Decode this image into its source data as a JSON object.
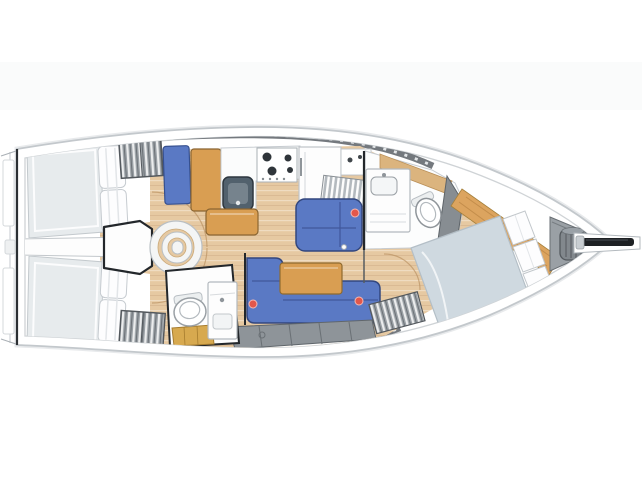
{
  "image": {
    "width": 642,
    "height": 481,
    "kind": "sailboat-interior-layout-plan",
    "orientation": "bow-right",
    "background": "#ffffff"
  },
  "palette": {
    "background": "#ffffff",
    "page_band": "#fafbfb",
    "hull_fill": "#ffffff",
    "hull_outline": "#c3c8cc",
    "hull_shadow": "#e8eaec",
    "gunwale": "#cfd3d6",
    "coachroof_band": "#74797e",
    "band_dash": "#e3e6e8",
    "floor_wood": "#e6c9a2",
    "floor_seam": "#c9a878",
    "furniture_wood": "#d99e52",
    "furniture_wood_edge": "#8a6532",
    "upholstery_blue": "#5a79c4",
    "upholstery_edge": "#33477e",
    "mattress_gray": "#e7ebed",
    "bed_duvet": "#cfd9e0",
    "pillow_white": "#fdfdfe",
    "locker_gray": "#9aa0a5",
    "locker_edge": "#53585d",
    "fixture_white": "#fdfdfd",
    "fixture_edge": "#b3b9be",
    "sink_slate": "#52616d",
    "accent_red": "#e2574b",
    "outline_dark": "#23272b",
    "windlass_gray": "#82888d",
    "bowsprit_black": "#1e2124",
    "gold_floor": "#d7a94f"
  },
  "regions": [
    {
      "id": "hull",
      "label": "hull outline"
    },
    {
      "id": "transom",
      "label": "stern transom with swim platform"
    },
    {
      "id": "aft-cabin-starboard",
      "label": "aft double cabin (top)"
    },
    {
      "id": "aft-cabin-port",
      "label": "aft double cabin (bottom)"
    },
    {
      "id": "companionway-steps",
      "label": "companionway steps"
    },
    {
      "id": "galley",
      "label": "galley with stove, sink, fridge"
    },
    {
      "id": "nav-seat",
      "label": "blue seat / chart area"
    },
    {
      "id": "saloon-settee-starboard",
      "label": "starboard settee"
    },
    {
      "id": "saloon-sofa-port",
      "label": "L-shaped port sofa"
    },
    {
      "id": "saloon-table",
      "label": "saloon table"
    },
    {
      "id": "aft-head",
      "label": "aft bathroom with toilet and sink"
    },
    {
      "id": "forward-head",
      "label": "forward bathroom with toilet and sink"
    },
    {
      "id": "forward-cabin",
      "label": "forward V-berth cabin"
    },
    {
      "id": "anchor-locker",
      "label": "anchor locker with windlass"
    },
    {
      "id": "bowsprit",
      "label": "bowsprit / anchor roller"
    }
  ],
  "markers": {
    "red_dots": [
      [
        355,
        213
      ],
      [
        253,
        304
      ],
      [
        359,
        301
      ]
    ],
    "white_dots": [
      [
        344,
        247
      ],
      [
        297,
        287
      ]
    ]
  }
}
